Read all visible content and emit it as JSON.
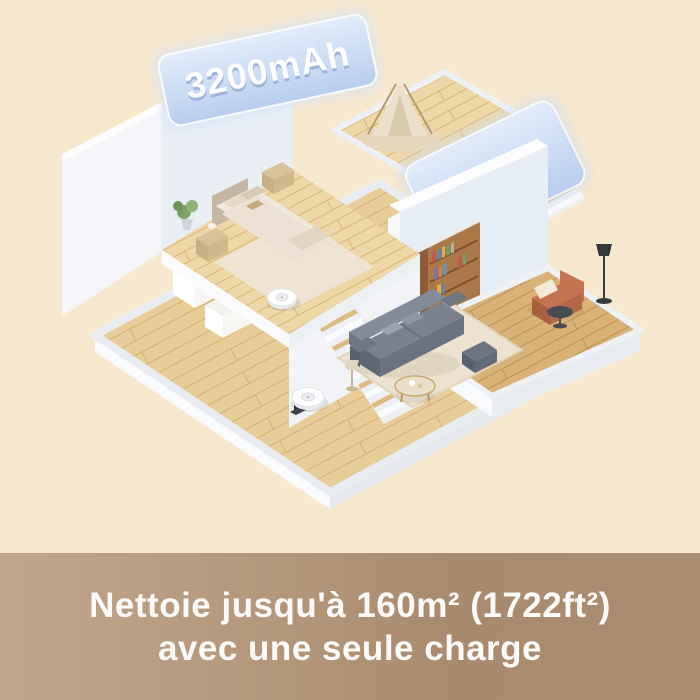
{
  "scene": {
    "badge_battery": "3200mAh",
    "badge_area": "1722ft²",
    "caption": {
      "line1": "Nettoie jusqu'à 160m² (1722ft²)",
      "line2": "avec une seule charge"
    },
    "colors": {
      "background": "#f8e8cd",
      "caption_band_start": "#c2a68a",
      "caption_band_end": "#aa8a6c",
      "caption_text": "#fdfcfa",
      "badge_panel": "#c5d7f2",
      "badge_text": "#ffffff",
      "wall_white": "#f3f5f8",
      "wood_light": "#e8cc98",
      "wood_mid": "#dab377",
      "sofa_grey": "#79828e",
      "armchair_terracotta": "#c4754f"
    }
  }
}
